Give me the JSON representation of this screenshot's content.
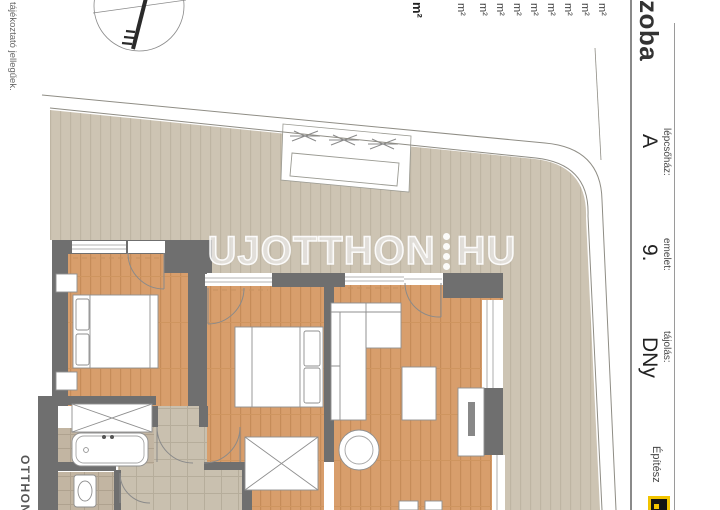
{
  "header": {
    "room_table": {
      "column_header": "szoba",
      "row_units": [
        "m²",
        "m²",
        "m²",
        "m²",
        "m²",
        "m²",
        "m²",
        "m²"
      ],
      "subtotal_unit": "m²",
      "total_unit": "m²"
    },
    "fields": [
      {
        "label": "lépcsőház:",
        "value": "A"
      },
      {
        "label": "emelet:",
        "value": "9."
      },
      {
        "label": "tájolás:",
        "value": "DNy"
      }
    ],
    "architect_label": "Építész"
  },
  "watermark": {
    "text_left": "UJOTTHON",
    "text_right": "HU"
  },
  "footer": {
    "disclaimer_fragment": "tájékoztató jellegűek.",
    "brand_fragment": "OTTHON"
  },
  "colors": {
    "wood_floor": "#d89e6c",
    "terrace_deck": "#cdc4b3",
    "wall": "#6f6f6f",
    "tile": "#c9c0af",
    "bath_tile": "#c2b5a2",
    "logo_yellow": "#f2c400",
    "watermark": "#ffffff"
  }
}
